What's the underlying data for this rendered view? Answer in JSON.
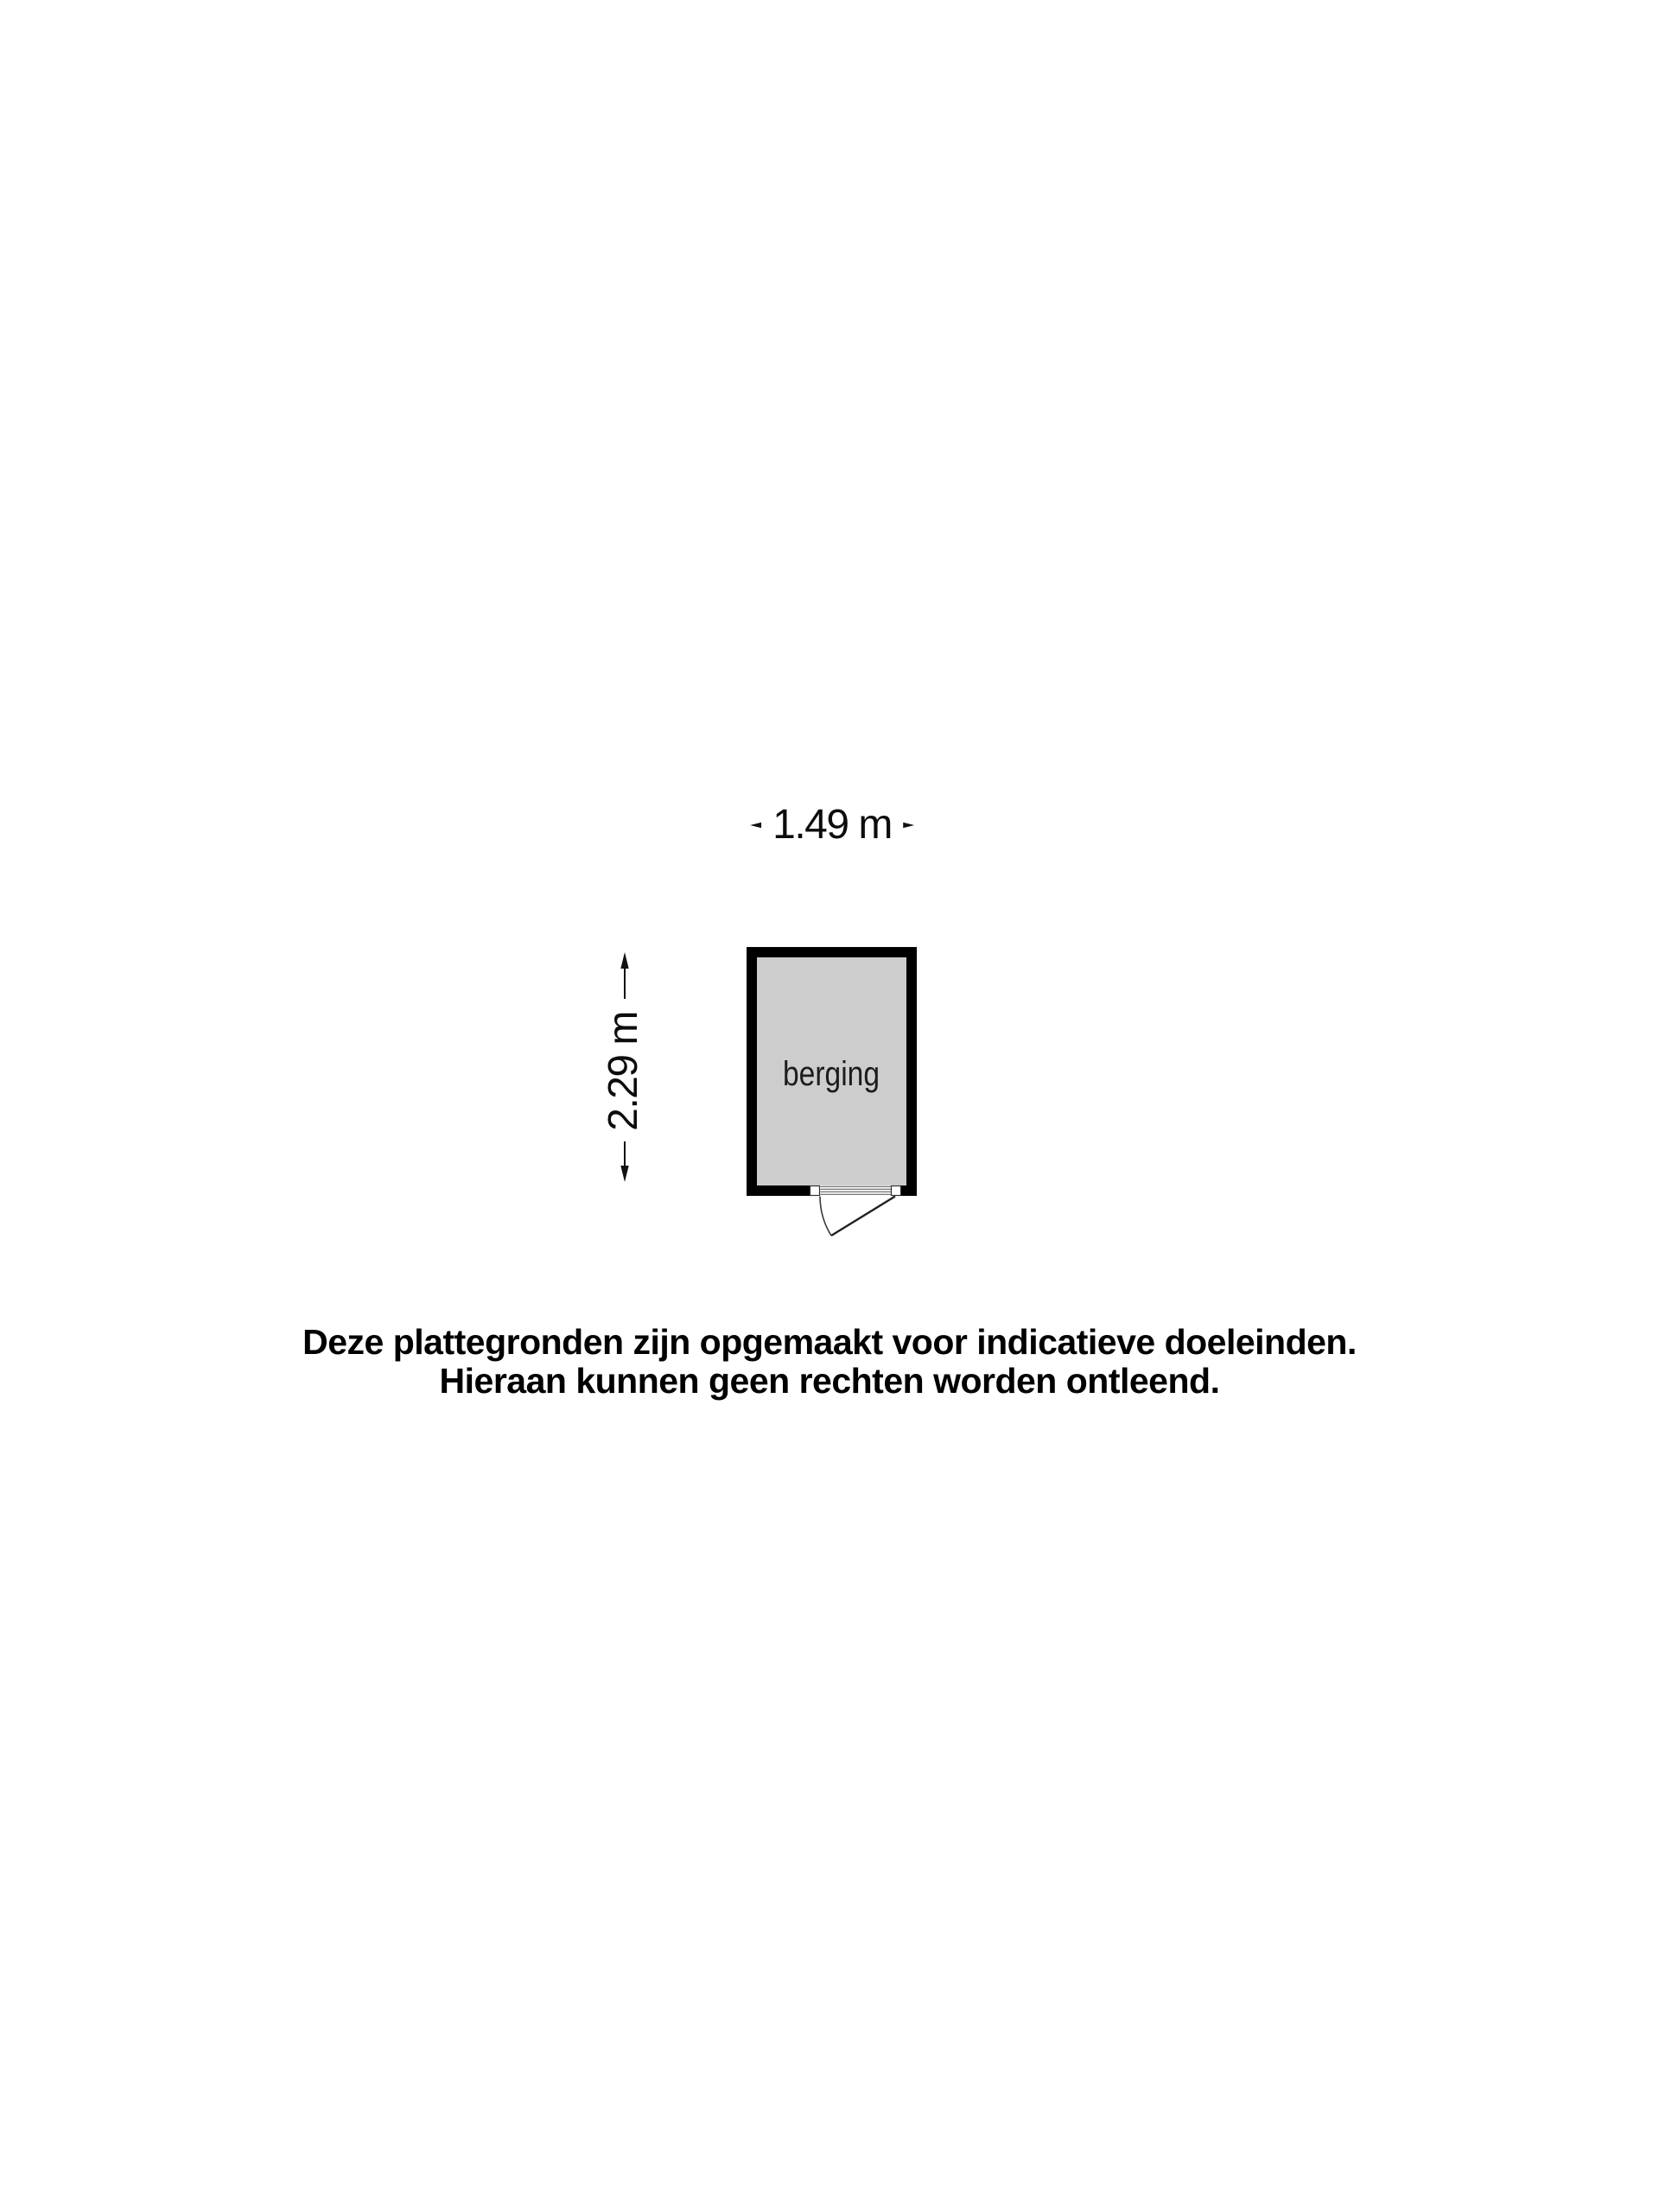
{
  "floorplan": {
    "room": {
      "label": "berging",
      "fill_color": "#cdcdcd",
      "wall_color": "#000000"
    },
    "dimensions": {
      "width": "1.49 m",
      "height": "2.29 m"
    }
  },
  "disclaimer": {
    "line1": "Deze plattegronden zijn opgemaakt voor indicatieve doeleinden.",
    "line2": "Hieraan kunnen geen rechten worden ontleend."
  }
}
